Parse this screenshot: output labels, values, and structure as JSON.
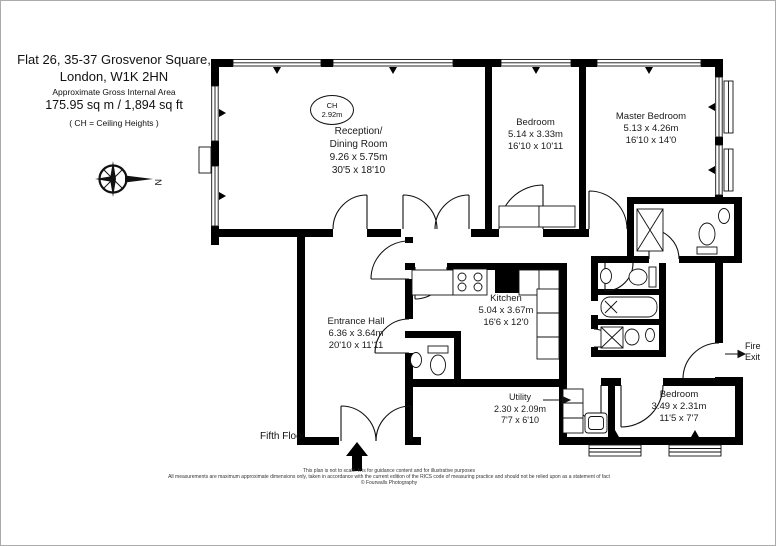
{
  "header": {
    "address_line1": "Flat 26, 35-37 Grosvenor Square,",
    "address_line2": "London, W1K 2HN",
    "area_label": "Approximate Gross Internal Area",
    "area_value": "175.95 sq m  /  1,894 sq ft",
    "ch_note": "( CH = Ceiling Heights )"
  },
  "compass": {
    "north": "N"
  },
  "rooms": {
    "reception": {
      "name1": "Reception/",
      "name2": "Dining Room",
      "metric": "9.26 x 5.75m",
      "imperial": "30'5 x 18'10",
      "ch_label": "CH",
      "ch_value": "2.92m"
    },
    "bedroom1": {
      "name": "Bedroom",
      "metric": "5.14 x 3.33m",
      "imperial": "16'10 x 10'11"
    },
    "master_bedroom": {
      "name": "Master Bedroom",
      "metric": "5.13 x 4.26m",
      "imperial": "16'10 x 14'0"
    },
    "kitchen": {
      "name": "Kitchen",
      "metric": "5.04 x 3.67m",
      "imperial": "16'6 x 12'0"
    },
    "entrance_hall": {
      "name": "Entrance Hall",
      "metric": "6.36 x 3.64m",
      "imperial": "20'10 x 11'11"
    },
    "utility": {
      "name": "Utility",
      "metric": "2.30 x 2.09m",
      "imperial": "7'7 x 6'10"
    },
    "bedroom2": {
      "name": "Bedroom",
      "metric": "3.49 x 2.31m",
      "imperial": "11'5 x 7'7"
    }
  },
  "annotations": {
    "floor_label": "Fifth Floor",
    "fire_exit_line1": "Fire",
    "fire_exit_line2": "Exit"
  },
  "footer": {
    "line1": "This plan is not to scale. It is for guidance content and for illustrative purposes",
    "line2": "All measurements are maximum approximate dimensions only, taken in accordance with the current edition of the RICS code of measuring practice and should not be relied upon as a statement of fact",
    "line3": "© Fourwalls Photography"
  }
}
